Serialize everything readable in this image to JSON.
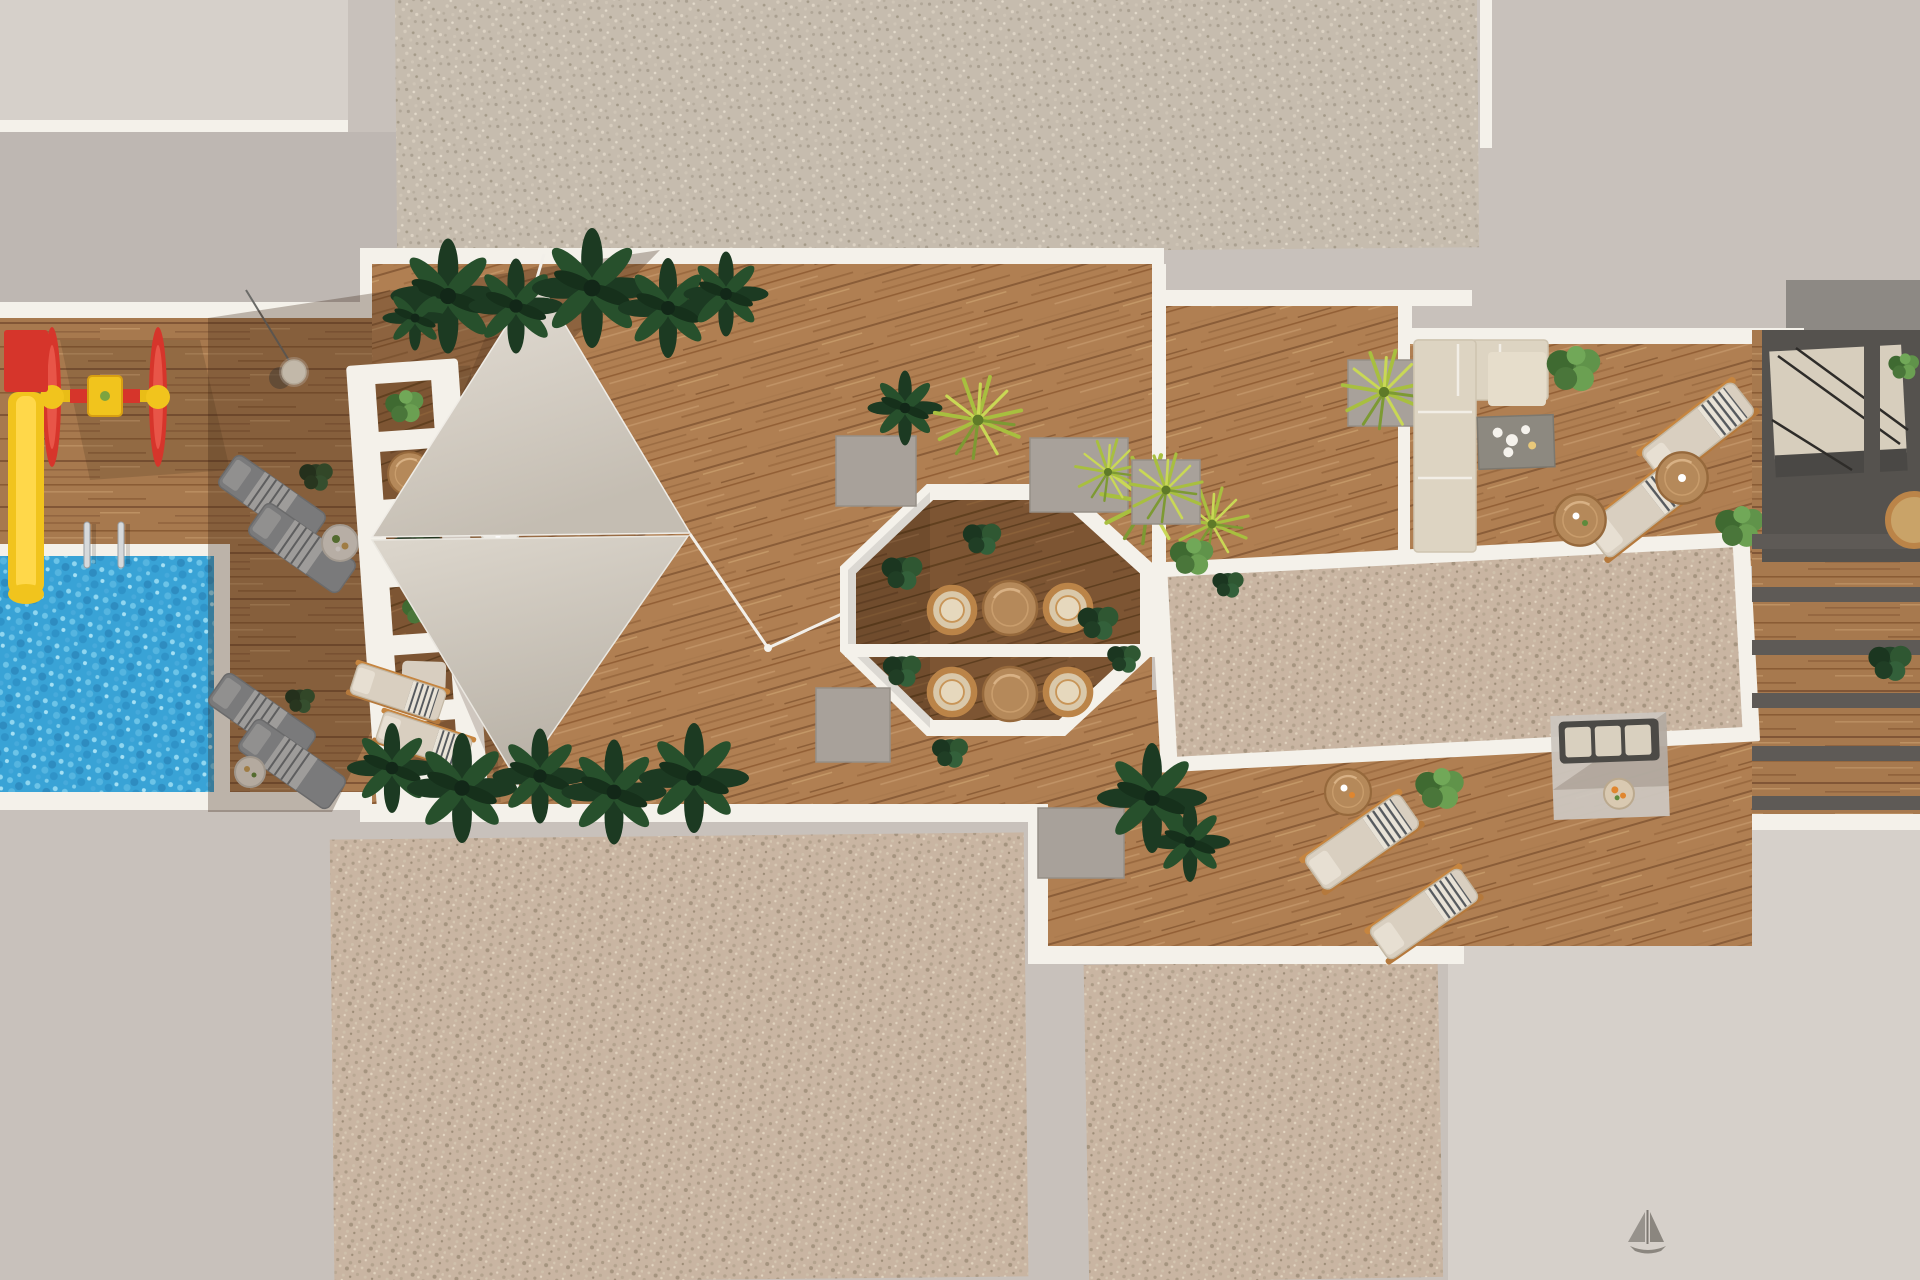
{
  "scene": {
    "kind": "aerial-3d-architectural-render",
    "view": "top-down",
    "subject": "rooftop amenity terrace between gravel building roofs",
    "zones": [
      {
        "id": "top-roof-gravel",
        "desc": "speckled gravel roof strip, top"
      },
      {
        "id": "plaza-paving",
        "desc": "plain concrete paving around terrace"
      },
      {
        "id": "pool-zone",
        "desc": "blue pool with ladder rails, kids playground, gray sun loungers, hanging bulb light"
      },
      {
        "id": "pergola-planter-wall",
        "desc": "white ladder-like planter wall with plants and round tables"
      },
      {
        "id": "sail-deck",
        "desc": "wood deck with two triangular shade sails, loungers, drink tables, tropical plant rows"
      },
      {
        "id": "octagon-pavilion",
        "desc": "white octagonal frame with rattan chairs, round wood tables, box hedges"
      },
      {
        "id": "framed-gravel-roof",
        "desc": "large white-framed gravel rectangle (skylight roof)"
      },
      {
        "id": "upper-lounge",
        "desc": "L-shaped sofa, gray coffee table with cups, two beige loungers, side tables, bushes"
      },
      {
        "id": "stairwell",
        "desc": "dark stair core with beige landing and railings"
      },
      {
        "id": "right-terrace-strip",
        "desc": "lower private terraces with dark pergola slats over wood"
      },
      {
        "id": "lower-lounge",
        "desc": "two beige loungers, side table, rug seating set with orange fruit, planters"
      },
      {
        "id": "bottom-roof-gravel",
        "desc": "two speckled gravel roof areas, bottom"
      },
      {
        "id": "sailboat-mark",
        "desc": "small sailboat glyph on paving, bottom right"
      }
    ]
  },
  "colors": {
    "paving": "#c8c1bb",
    "paving_light": "#d6d0ca",
    "paving_dark": "#beb7b2",
    "wall_white": "#f4f1ea",
    "gravel_tan": "#c9b5a2",
    "gravel_gray": "#c6bcae",
    "wood": "#b07f52",
    "wood_shaded": "#a0714a",
    "wood_dark": "#7d5533",
    "water_blue": "#39a3d6",
    "sail_beige": "#d8d2c8",
    "plant_dark": "#1c3a22",
    "plant_green": "#4e7a3c",
    "plant_yellow": "#a8bf3f",
    "lounger_beige": "#d9cfc0",
    "lounger_gray": "#96a0a8",
    "sofa_beige": "#ddd4c2",
    "table_gray": "#8d8980",
    "rattan": "#bb8448",
    "table_wood": "#b5895a",
    "play_red": "#d6352b",
    "play_yellow": "#f1c41d",
    "frame_orange": "#c6853f",
    "dark_structure": "#55524e",
    "stair_beige": "#d7cebd",
    "planter_gray": "#a8a19a",
    "shadow": "#3a2514",
    "accent_orange": "#e0862f"
  }
}
